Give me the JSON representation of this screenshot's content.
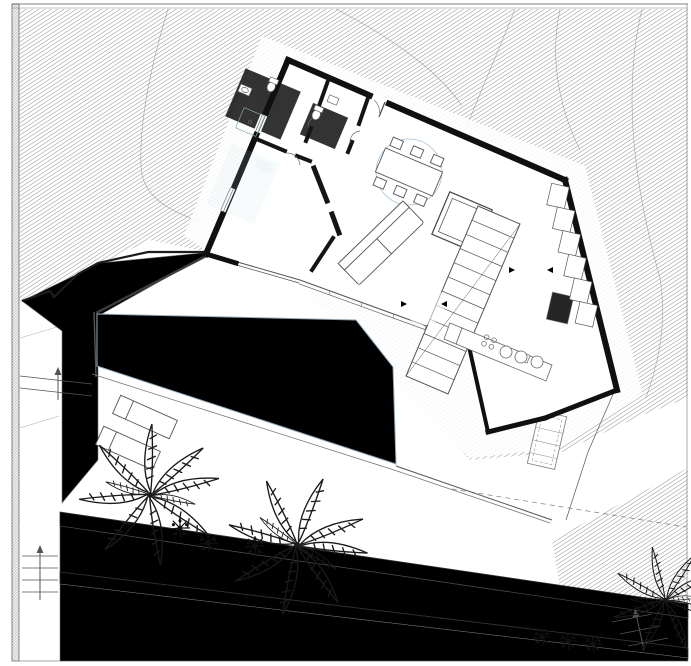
{
  "plan": {
    "floor": {
      "title": "PLANTA BAJA",
      "area": "97.40 m2"
    },
    "rooms": {
      "bano": {
        "name": "Baño 1",
        "area": "3.96 m2"
      },
      "aseo": {
        "name": "Aseo 1",
        "area": "2.67 m2"
      },
      "distribuidor": {
        "name": "Distribuidor",
        "area": "1.60 m2"
      },
      "habitacion": {
        "name": "Habitación 1",
        "area": "12.33 m2"
      },
      "salon": {
        "name": "Salón-comedor",
        "area": "36.51 m2"
      },
      "cocina": {
        "name": "Cocina",
        "area": "24.49 m2"
      }
    },
    "exterior": {
      "piscina": {
        "name": "Piscina",
        "area": "43.80 m2"
      },
      "terraza": {
        "name": "Terraza 1",
        "area": "119.78 m2"
      }
    },
    "dimension_markers": {
      "left": "1.2000",
      "right": "1.2000"
    }
  },
  "colors": {
    "wall": "#101010",
    "terrain_hatch": "#969696",
    "vegetation_olive": "#c8c7a0",
    "planter_pale": "#e9e8c4",
    "wall_band_gray": "#b7b5a0",
    "pool_blue": "#e9f2fa",
    "bath_tile_blue": "#d0dfee",
    "appliance_blue": "#ccd7e8",
    "bed_teal": "#3fa3a6",
    "dimension_blue": "#9fc2da"
  }
}
